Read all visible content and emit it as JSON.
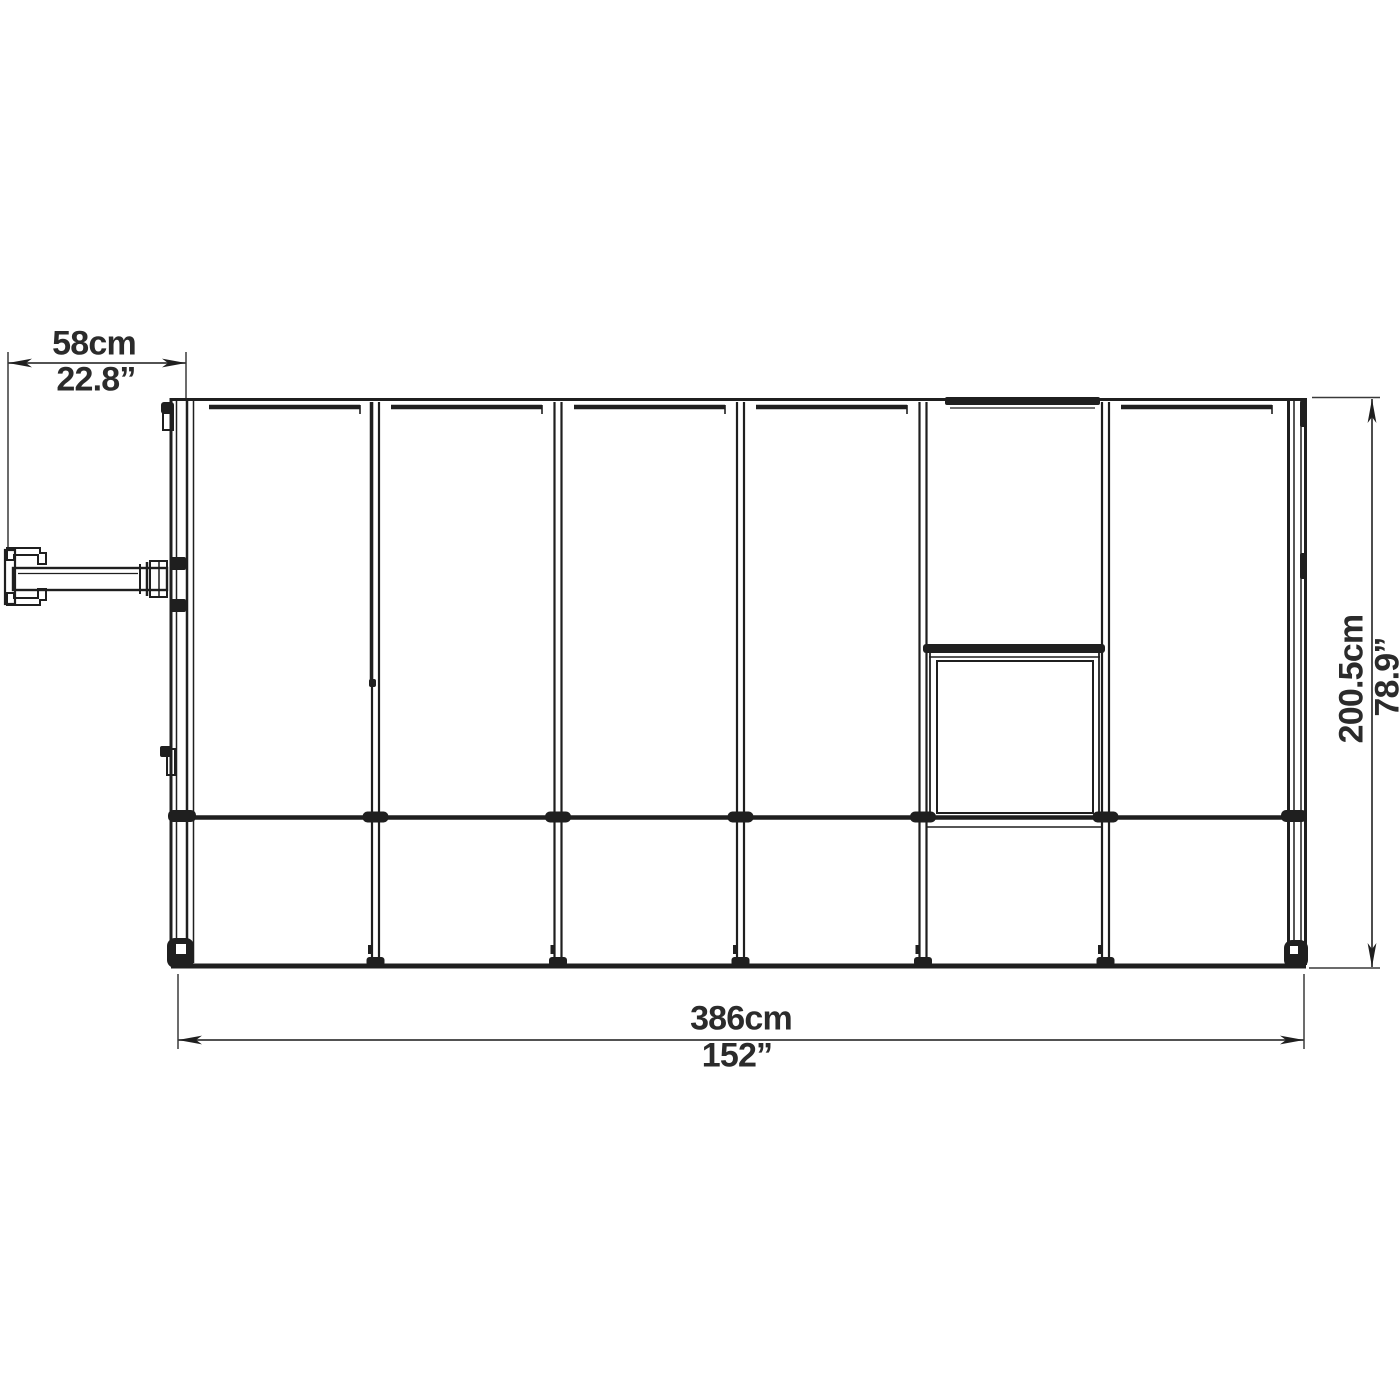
{
  "canvas": {
    "background": "#ffffff",
    "line_color": "#1f1f1f",
    "text_color": "#2b2b2b"
  },
  "drawing": {
    "name": "greenhouse-side-elevation",
    "panel_count": 6,
    "dimensions": {
      "handle_offset": {
        "metric": "58cm",
        "imperial": "22.8”"
      },
      "overall_width": {
        "metric": "386cm",
        "imperial": "152”"
      },
      "overall_height": {
        "metric": "200.5cm",
        "imperial": "78.9”"
      }
    }
  }
}
